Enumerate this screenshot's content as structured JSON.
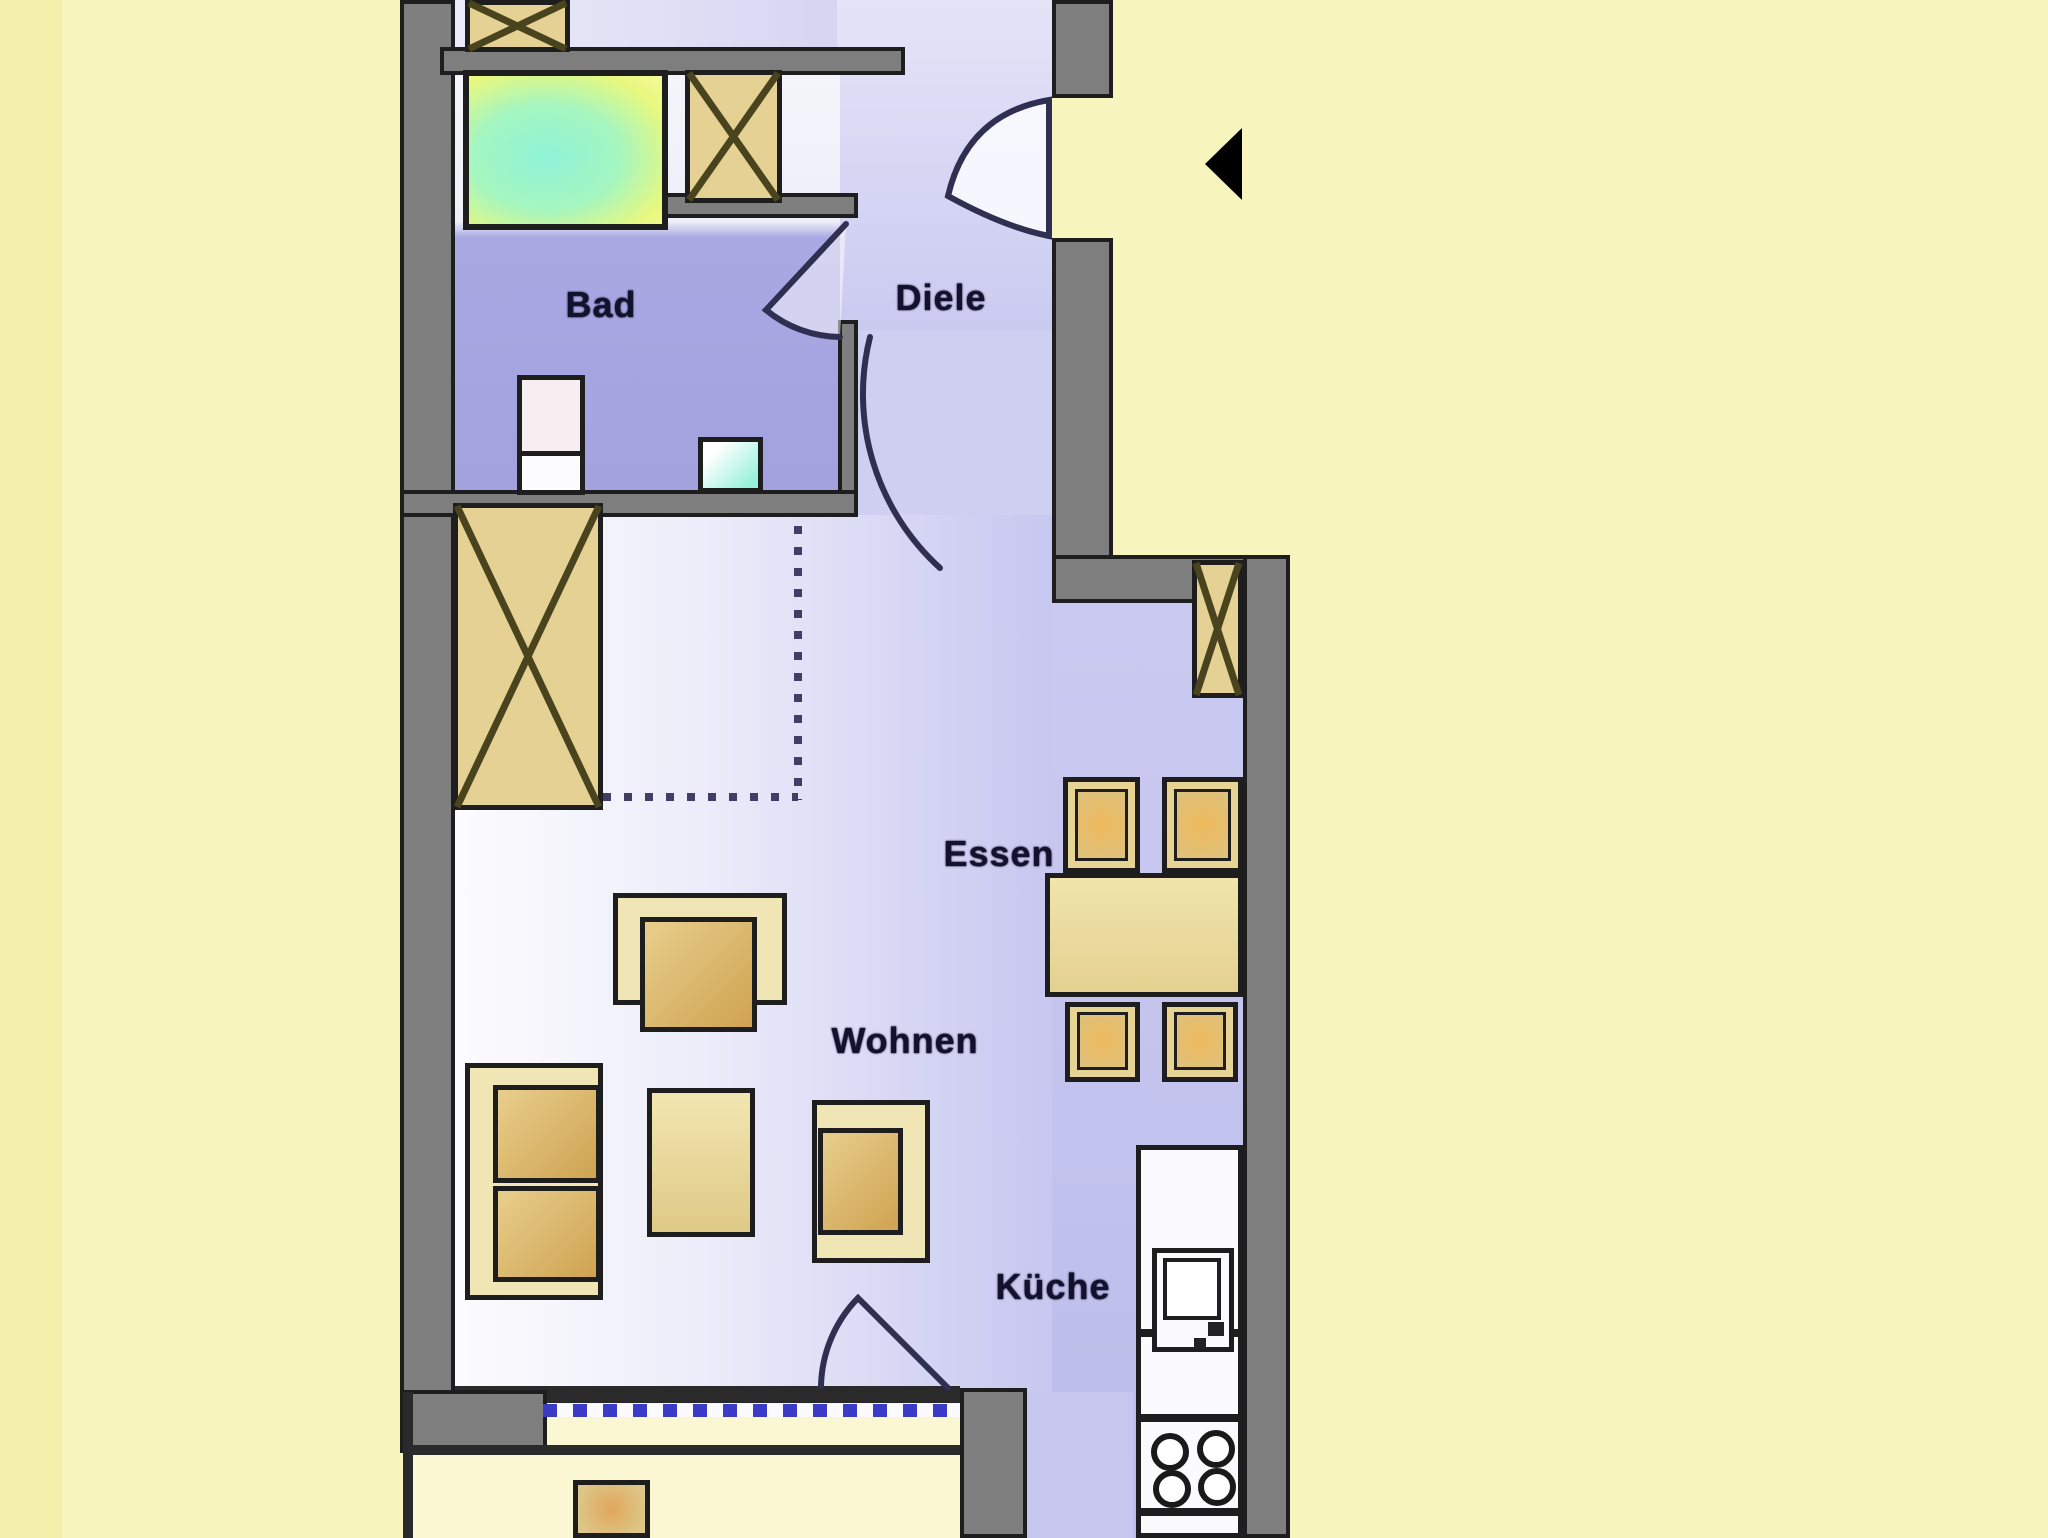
{
  "palette": {
    "background": "#F8F4BE",
    "wall": "#7E7E7E",
    "wallEdge": "#1E1E1E",
    "shaftFill": "#E5D193",
    "shaftLine": "#4A441E",
    "furnLight": "#F0E5B5",
    "furnBorder": "#2E2A12",
    "seatGrad": "linear-gradient(135deg,#E8CE8C 0%,#CFA351 100%)",
    "doorStroke": "#2F2F52",
    "labelColor": "#12122E",
    "windowDashBlue": "#3B3BC8",
    "balconyFloor": "#FAF7D2",
    "bathFloor": "#A2A2DF",
    "roomLavender": "#C7C7F0"
  },
  "rooms": {
    "bad": {
      "label": "Bad",
      "box": [
        556,
        282,
        90,
        46
      ]
    },
    "diele": {
      "label": "Diele",
      "box": [
        886,
        275,
        110,
        46
      ]
    },
    "essen": {
      "label": "Essen",
      "box": [
        936,
        831,
        126,
        46
      ]
    },
    "wohnen": {
      "label": "Wohnen",
      "box": [
        823,
        1017,
        164,
        48
      ]
    },
    "kueche": {
      "label": "Küche",
      "box": [
        986,
        1263,
        134,
        48
      ]
    }
  },
  "scene": [
    {
      "n": "bg-left-strip",
      "t": "rect",
      "x": 0,
      "y": 0,
      "w": 62,
      "h": 1538,
      "f": "#F5EFAC"
    },
    {
      "n": "floor-top-room",
      "t": "rect",
      "x": 443,
      "y": 0,
      "w": 609,
      "h": 50,
      "f": "linear-gradient(90deg,#ECECF9,#C9C9EF)"
    },
    {
      "n": "floor-hallway",
      "t": "rect",
      "x": 837,
      "y": 0,
      "w": 215,
      "h": 335,
      "f": "linear-gradient(180deg,#E4E4F8,#CACAF1)"
    },
    {
      "n": "floor-passage",
      "t": "rect",
      "x": 857,
      "y": 330,
      "w": 195,
      "h": 190,
      "f": "#CFCFF2"
    },
    {
      "n": "floor-bathroom",
      "t": "rect",
      "x": 443,
      "y": 70,
      "w": 397,
      "h": 420,
      "f": "linear-gradient(180deg,#F4F4FB 0%,#EFEFF9 36%,#A8A8E3 40%,#A2A2DF 100%)"
    },
    {
      "n": "floor-living-room",
      "t": "rect",
      "x": 455,
      "y": 515,
      "w": 597,
      "h": 877,
      "f": "linear-gradient(90deg,#FCFCFE 0%,#EDEDFA 40%,#C7C7F0 100%)"
    },
    {
      "n": "floor-dining-kitchen",
      "t": "rect",
      "x": 1052,
      "y": 600,
      "w": 191,
      "h": 938,
      "f": "linear-gradient(180deg,#CACAF1,#BCBCEB)"
    },
    {
      "n": "floor-kitchen-walkway",
      "t": "rect",
      "x": 1027,
      "y": 1392,
      "w": 106,
      "h": 146,
      "f": "#C6C6EF"
    },
    {
      "n": "floor-balcony",
      "t": "rect",
      "x": 413,
      "y": 1403,
      "w": 547,
      "h": 135,
      "f": "#FAF7D2"
    },
    {
      "n": "storage-divider-vertical",
      "t": "rect",
      "x": 794,
      "y": 505,
      "w": 8,
      "h": 295,
      "f": "repeating-linear-gradient(180deg,#3E3E66 0 8px,transparent 8px 21px)"
    },
    {
      "n": "storage-divider-horizontal",
      "t": "rect",
      "x": 603,
      "y": 793,
      "w": 195,
      "h": 8,
      "f": "repeating-linear-gradient(90deg,#3E3E66 0 8px,transparent 8px 21px)"
    },
    {
      "n": "wall-left-outer",
      "t": "rect",
      "x": 400,
      "y": 0,
      "w": 55,
      "h": 1450,
      "f": "wall",
      "b": 4
    },
    {
      "n": "wall-top-divider",
      "t": "rect",
      "x": 440,
      "y": 47,
      "w": 465,
      "h": 28,
      "f": "wall",
      "b": 4
    },
    {
      "n": "wall-shaft-bottom",
      "t": "rect",
      "x": 658,
      "y": 193,
      "w": 200,
      "h": 25,
      "f": "wall",
      "b": 4
    },
    {
      "n": "wall-bath-right",
      "t": "rect",
      "x": 838,
      "y": 320,
      "w": 20,
      "h": 175,
      "f": "wall",
      "b": 4
    },
    {
      "n": "wall-bath-bottom",
      "t": "rect",
      "x": 400,
      "y": 490,
      "w": 458,
      "h": 27,
      "f": "wall",
      "b": 4
    },
    {
      "n": "wall-entrance-top",
      "t": "rect",
      "x": 1052,
      "y": 0,
      "w": 61,
      "h": 98,
      "f": "wall",
      "b": 4
    },
    {
      "n": "wall-entrance-bottom",
      "t": "rect",
      "x": 1052,
      "y": 238,
      "w": 61,
      "h": 365,
      "f": "wall",
      "b": 4
    },
    {
      "n": "wall-right-upper",
      "t": "rect",
      "x": 1052,
      "y": 555,
      "w": 238,
      "h": 48,
      "f": "wall",
      "b": 4
    },
    {
      "n": "wall-right-outer",
      "t": "rect",
      "x": 1243,
      "y": 555,
      "w": 47,
      "h": 983,
      "f": "wall",
      "b": 4
    },
    {
      "n": "wall-window-line",
      "t": "rect",
      "x": 455,
      "y": 1386,
      "w": 505,
      "h": 17,
      "f": "#2A2A2A"
    },
    {
      "n": "wall-balcony-block",
      "t": "rect",
      "x": 400,
      "y": 1390,
      "w": 147,
      "h": 63,
      "f": "wall",
      "b": 4
    },
    {
      "n": "wall-balcony-column",
      "t": "rect",
      "x": 960,
      "y": 1388,
      "w": 67,
      "h": 150,
      "f": "wall",
      "b": 4
    },
    {
      "n": "balcony-edge-horizontal",
      "t": "rect",
      "x": 403,
      "y": 1445,
      "w": 557,
      "h": 10,
      "f": "#2A2A2A"
    },
    {
      "n": "balcony-edge-vertical",
      "t": "rect",
      "x": 403,
      "y": 1392,
      "w": 10,
      "h": 146,
      "f": "#2A2A2A"
    },
    {
      "n": "window-dashed-line",
      "t": "rect",
      "x": 543,
      "y": 1404,
      "w": 417,
      "h": 13,
      "f": "repeating-linear-gradient(90deg,#3B3BC8 0 14px,#FAFAFF 14px 30px)"
    },
    {
      "n": "shaft-top-left",
      "t": "shaft",
      "x": 465,
      "y": 0,
      "w": 105,
      "h": 52,
      "f": "shaftFill",
      "b": 5
    },
    {
      "n": "shaft-bathroom",
      "t": "shaft",
      "x": 685,
      "y": 70,
      "w": 97,
      "h": 133,
      "f": "shaftFill",
      "b": 5
    },
    {
      "n": "wardrobe-living",
      "t": "shaft",
      "x": 453,
      "y": 503,
      "w": 150,
      "h": 307,
      "f": "shaftFill",
      "b": 5
    },
    {
      "n": "shaft-window-right",
      "t": "shaft",
      "x": 1192,
      "y": 560,
      "w": 51,
      "h": 138,
      "f": "shaftFill",
      "b": 5
    },
    {
      "n": "shower-tray",
      "t": "rect",
      "x": 463,
      "y": 70,
      "w": 205,
      "h": 160,
      "b": 6,
      "f": "radial-gradient(ellipse at 40% 55%,#8FF3D7 0%,#A5F6C0 45%,#E8F87E 80%,#F4FA9C 100%)"
    },
    {
      "n": "toilet",
      "t": "rect",
      "x": 517,
      "y": 375,
      "w": 68,
      "h": 120,
      "b": 5,
      "f": "#F7EEF1"
    },
    {
      "n": "toilet-cistern",
      "t": "rect",
      "x": 517,
      "y": 451,
      "w": 68,
      "h": 44,
      "b": 5,
      "f": "#FCFCFE"
    },
    {
      "n": "washbasin",
      "t": "rect",
      "x": 698,
      "y": 437,
      "w": 65,
      "h": 56,
      "b": 5,
      "f": "linear-gradient(135deg,#FFFFFF 20%,#96F1DB 90%)"
    },
    {
      "n": "armchair-top-outer",
      "t": "rect",
      "x": 613,
      "y": 893,
      "w": 174,
      "h": 112,
      "b": 5,
      "f": "furnLight"
    },
    {
      "n": "armchair-top-seat",
      "t": "rect",
      "x": 640,
      "y": 917,
      "w": 117,
      "h": 115,
      "b": 5,
      "f": "seatGrad"
    },
    {
      "n": "sofa-outer",
      "t": "rect",
      "x": 465,
      "y": 1063,
      "w": 138,
      "h": 237,
      "b": 5,
      "f": "furnLight"
    },
    {
      "n": "sofa-seat-1",
      "t": "rect",
      "x": 493,
      "y": 1085,
      "w": 108,
      "h": 98,
      "b": 5,
      "f": "seatGrad"
    },
    {
      "n": "sofa-seat-2",
      "t": "rect",
      "x": 493,
      "y": 1186,
      "w": 108,
      "h": 96,
      "b": 5,
      "f": "seatGrad"
    },
    {
      "n": "coffee-table",
      "t": "rect",
      "x": 647,
      "y": 1088,
      "w": 108,
      "h": 149,
      "b": 5,
      "f": "linear-gradient(180deg,#F2E6B0,#DFC987)"
    },
    {
      "n": "armchair-right-outer",
      "t": "rect",
      "x": 812,
      "y": 1100,
      "w": 118,
      "h": 163,
      "b": 5,
      "f": "furnLight"
    },
    {
      "n": "armchair-right-seat",
      "t": "rect",
      "x": 818,
      "y": 1128,
      "w": 85,
      "h": 107,
      "b": 5,
      "f": "seatGrad"
    },
    {
      "n": "dining-table",
      "t": "rect",
      "x": 1045,
      "y": 873,
      "w": 198,
      "h": 124,
      "b": 5,
      "f": "linear-gradient(180deg,#F0E4AC,#E3D190)"
    },
    {
      "n": "dining-chair-1",
      "t": "rect",
      "x": 1063,
      "y": 777,
      "w": 77,
      "h": 96,
      "b": 5,
      "f": "#E7D494"
    },
    {
      "n": "dining-chair-2",
      "t": "rect",
      "x": 1162,
      "y": 777,
      "w": 81,
      "h": 96,
      "b": 5,
      "f": "#E7D494"
    },
    {
      "n": "dining-chair-3",
      "t": "rect",
      "x": 1065,
      "y": 1002,
      "w": 75,
      "h": 80,
      "b": 5,
      "f": "#E7D494"
    },
    {
      "n": "dining-chair-4",
      "t": "rect",
      "x": 1162,
      "y": 1002,
      "w": 76,
      "h": 80,
      "b": 5,
      "f": "#E7D494"
    },
    {
      "n": "dining-chair-1-seat",
      "t": "rect",
      "x": 1075,
      "y": 789,
      "w": 53,
      "h": 72,
      "b": 3,
      "f": "radial-gradient(circle,#EFB95C 0%,#DCC27E 100%)"
    },
    {
      "n": "dining-chair-2-seat",
      "t": "rect",
      "x": 1174,
      "y": 789,
      "w": 57,
      "h": 72,
      "b": 3,
      "f": "radial-gradient(circle,#EFB95C 0%,#DCC27E 100%)"
    },
    {
      "n": "dining-chair-3-seat",
      "t": "rect",
      "x": 1077,
      "y": 1012,
      "w": 51,
      "h": 58,
      "b": 3,
      "f": "radial-gradient(circle,#EFB95C 0%,#DCC27E 100%)"
    },
    {
      "n": "dining-chair-4-seat",
      "t": "rect",
      "x": 1174,
      "y": 1012,
      "w": 52,
      "h": 58,
      "b": 3,
      "f": "radial-gradient(circle,#EFB95C 0%,#DCC27E 100%)"
    },
    {
      "n": "kitchen-counter",
      "t": "rect",
      "x": 1136,
      "y": 1145,
      "w": 107,
      "h": 393,
      "b": 5,
      "f": "#FBFBFD"
    },
    {
      "n": "kitchen-separator-1",
      "t": "rect",
      "x": 1136,
      "y": 1329,
      "w": 107,
      "h": 8,
      "f": "#1E1E1E"
    },
    {
      "n": "kitchen-separator-2",
      "t": "rect",
      "x": 1136,
      "y": 1414,
      "w": 107,
      "h": 8,
      "f": "#1E1E1E"
    },
    {
      "n": "kitchen-separator-3",
      "t": "rect",
      "x": 1136,
      "y": 1508,
      "w": 107,
      "h": 8,
      "f": "#1E1E1E"
    },
    {
      "n": "sink-unit",
      "t": "rect",
      "x": 1152,
      "y": 1248,
      "w": 82,
      "h": 104,
      "b": 5,
      "f": "#FBFBFD"
    },
    {
      "n": "sink-basin",
      "t": "rect",
      "x": 1163,
      "y": 1258,
      "w": 58,
      "h": 62,
      "b": 4,
      "f": "#FFFFFF"
    },
    {
      "n": "sink-faucet-a",
      "t": "rect",
      "x": 1208,
      "y": 1322,
      "w": 16,
      "h": 14,
      "f": "#222222"
    },
    {
      "n": "sink-faucet-b",
      "t": "rect",
      "x": 1194,
      "y": 1338,
      "w": 12,
      "h": 10,
      "f": "#222222"
    },
    {
      "n": "balcony-planter",
      "t": "rect",
      "x": 573,
      "y": 1480,
      "w": 77,
      "h": 58,
      "b": 5,
      "f": "radial-gradient(circle,#E2A75C 0%,#DCC788 85%)"
    }
  ],
  "circles": [
    {
      "n": "stove-burner-1",
      "cx": 1170,
      "cy": 1452,
      "r": 16
    },
    {
      "n": "stove-burner-2",
      "cx": 1216,
      "cy": 1449,
      "r": 16
    },
    {
      "n": "stove-burner-3",
      "cx": 1172,
      "cy": 1489,
      "r": 16
    },
    {
      "n": "stove-burner-4",
      "cx": 1217,
      "cy": 1487,
      "r": 16
    }
  ],
  "paths": [
    {
      "n": "entrance-door-swing",
      "d": "M 1049 100 Q 967 114 948 196 Q 1004 227 1049 236 Z",
      "fill": "rgba(250,250,255,0.9)",
      "stroke": "#2F2F52",
      "sw": 6
    },
    {
      "n": "bathroom-door-swing",
      "d": "M 846 224 L 766 310 A 118 118 0 0 0 840 337",
      "fill": "rgba(255,255,255,0.5)",
      "stroke": "#2F2F52",
      "sw": 6
    },
    {
      "n": "living-door-swing",
      "d": "M 940 568 A 235 235 0 0 1 870 337",
      "fill": "none",
      "stroke": "#2F2F52",
      "sw": 6
    },
    {
      "n": "balcony-door-swing",
      "d": "M 948 1388 L 858 1298 A 130 130 0 0 0 821 1386",
      "fill": "none",
      "stroke": "#2F2F52",
      "sw": 6
    },
    {
      "n": "north-arrow",
      "d": "M 1205 164 L 1242 128 L 1242 200 Z",
      "fill": "#000000",
      "stroke": "none",
      "sw": 0
    }
  ]
}
